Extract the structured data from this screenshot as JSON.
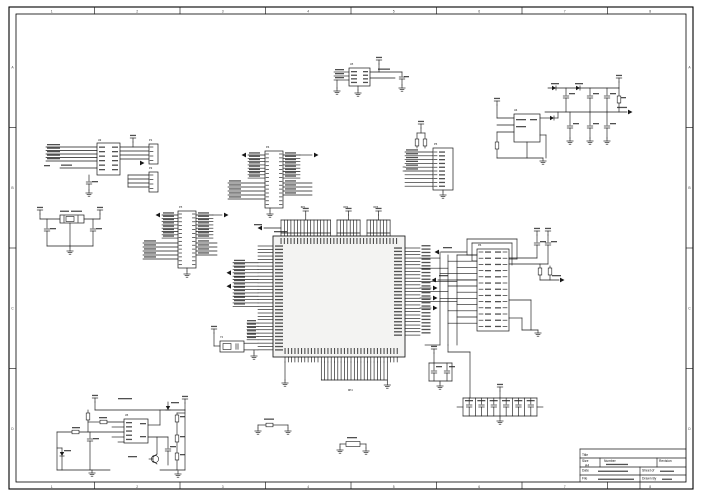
{
  "sheet": {
    "grid_cols": [
      "1",
      "2",
      "3",
      "4",
      "5",
      "6",
      "7",
      "8"
    ],
    "grid_rows": [
      "A",
      "B",
      "C",
      "D"
    ]
  },
  "title_block": {
    "title_label": "Title",
    "size_label": "Size",
    "size_value": "A4",
    "number_label": "Number",
    "revision_label": "Revision",
    "date_label": "Date",
    "sheet_label": "Sheet of",
    "file_label": "File",
    "drawn_label": "Drawn By"
  },
  "components": {
    "mcu": "U1",
    "interface_ic": "U2",
    "oscillator": "U3",
    "regulator": "U4",
    "audio_ic": "U5",
    "conn_a": "P1",
    "conn_b": "P2",
    "header_a": "P3",
    "header_b": "P4",
    "aux_conn": "P5",
    "right_conn": "P6",
    "crystal_left": "Y1",
    "crystal_mcu": "Y2",
    "rnet_1": "RP1",
    "rnet_2": "RP2",
    "rnet_3": "RP3",
    "rnet_4": "RP4"
  },
  "colors": {
    "line": "#181818",
    "ic_fill": "#f3f3f2",
    "paper": "#ffffff"
  }
}
